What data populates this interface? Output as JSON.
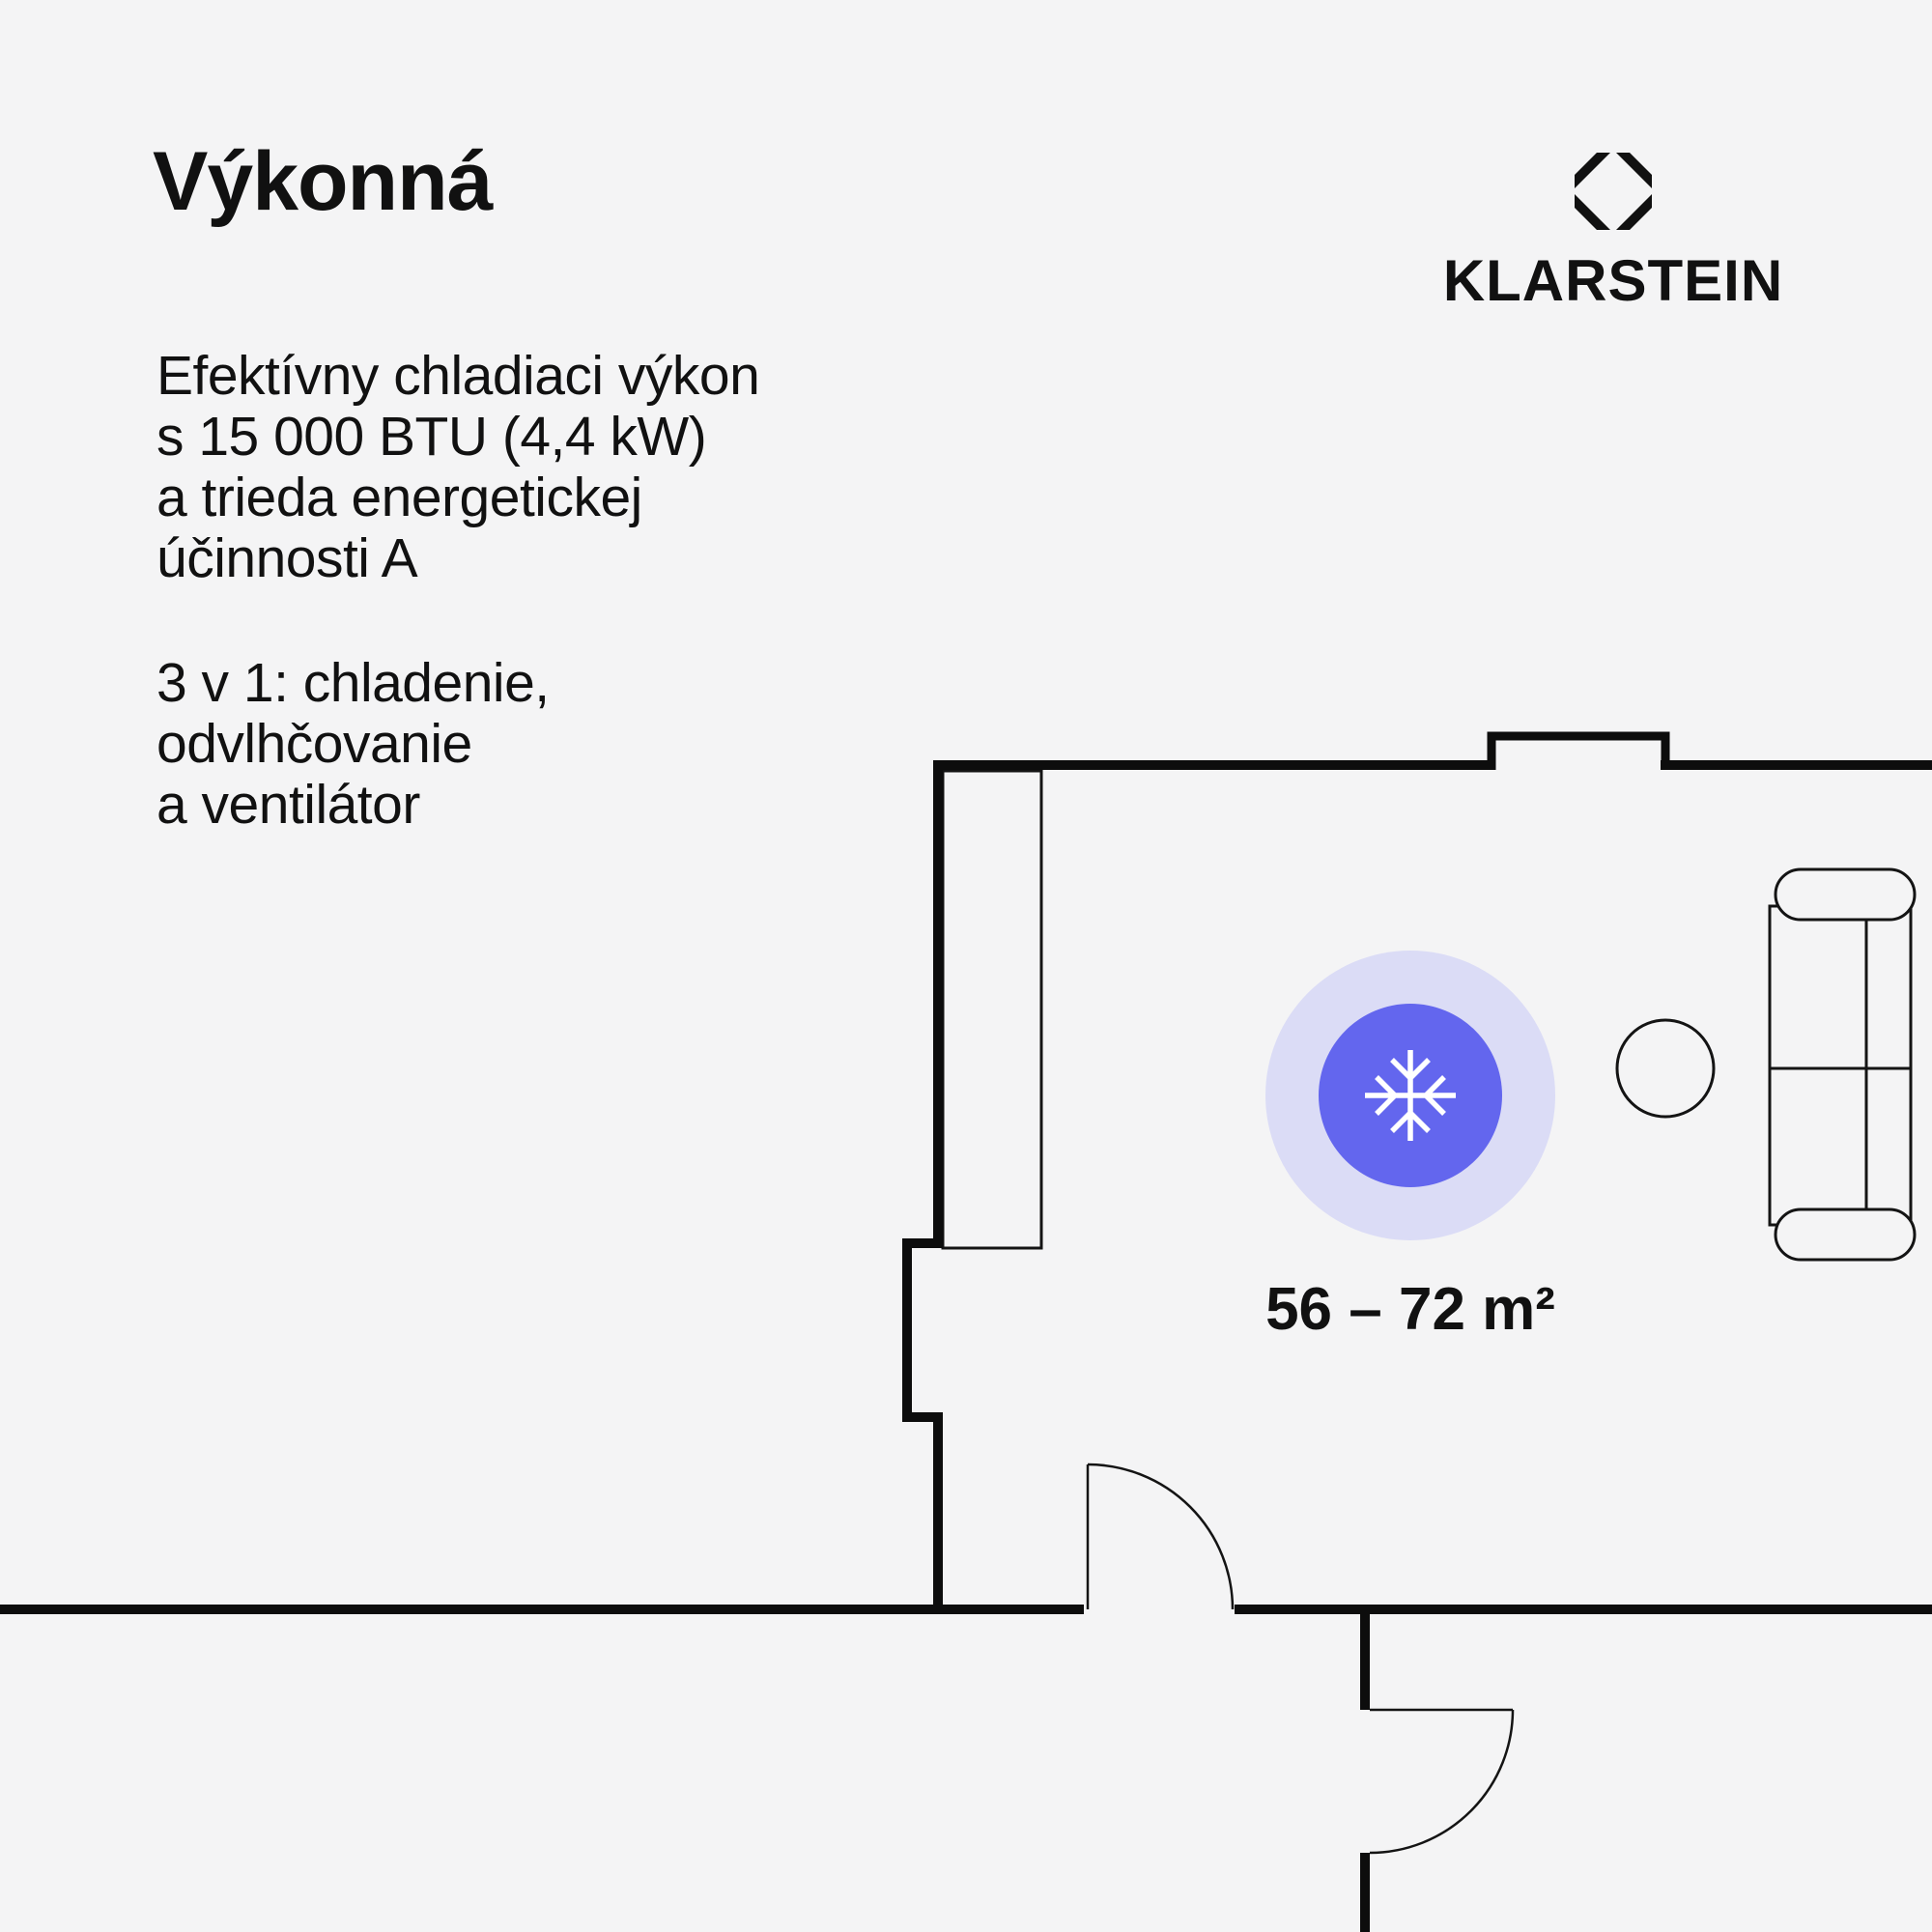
{
  "page": {
    "colors": {
      "background": "#F4F4F5",
      "ink": "#111111",
      "wall": "#0D0D0D",
      "accent": "#6366EE",
      "accent_halo": "#DBDCF6",
      "furniture_outline": "#141414"
    }
  },
  "header": {
    "title": "Výkonná"
  },
  "features": {
    "paragraph1": [
      "Efektívny chladiaci výkon",
      "s 15 000 BTU (4,4 kW)",
      "a trieda energetickej",
      "účinnosti A"
    ],
    "paragraph2": [
      "3 v 1: chladenie,",
      "odvlhčovanie",
      "a ventilátor"
    ]
  },
  "brand": {
    "name": "KLARSTEIN",
    "logo_icon": "klarstein-diamond-logo"
  },
  "floorplan": {
    "area_label": "56 – 72 m²",
    "badge_icon": "snowflake"
  }
}
